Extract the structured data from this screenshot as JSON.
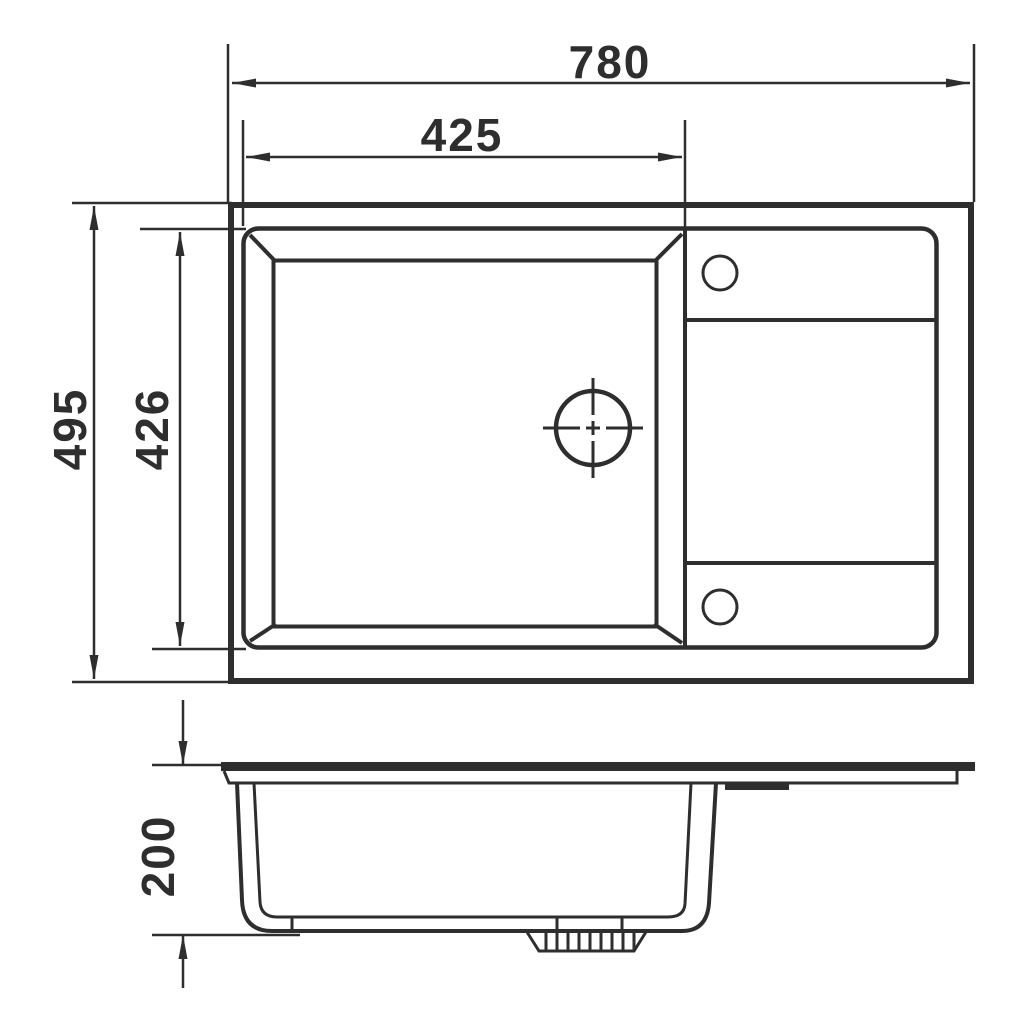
{
  "title": "Kitchen sink dimension drawing",
  "colors": {
    "line": "#2e2e2e",
    "background": "#ffffff"
  },
  "dimensions": {
    "overall_width": "780",
    "bowl_width": "425",
    "overall_depth": "495",
    "bowl_depth": "426",
    "bowl_height": "200"
  },
  "views": {
    "top_view": "plan view of sink with bowl, drain hole, two tap holes and drainer board",
    "side_view": "cross-section profile with bowl and waste fitting"
  }
}
